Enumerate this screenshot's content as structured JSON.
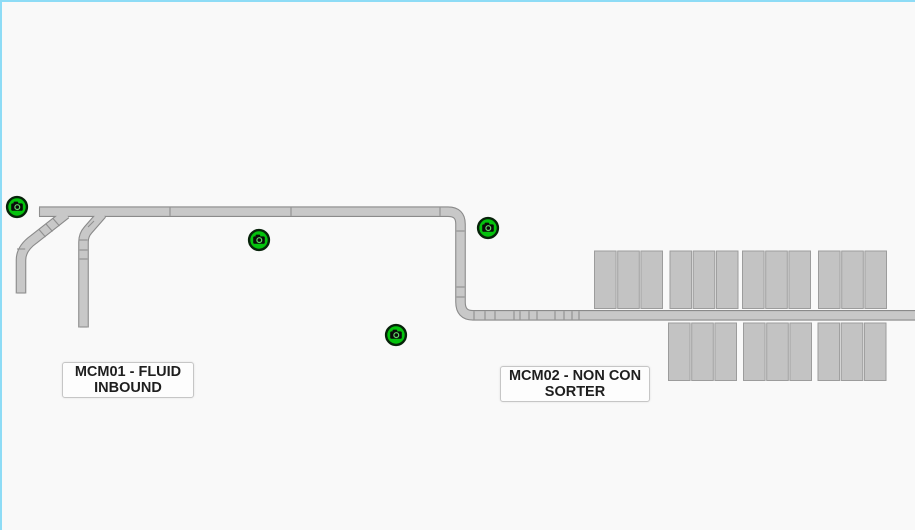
{
  "scene": {
    "background": "#f9f9f9",
    "frame_border_color": "#8edcf6"
  },
  "zone_labels": [
    {
      "id": "mcm01",
      "text": "MCM01 - FLUID\nINBOUND",
      "x": 60,
      "y": 360,
      "w": 132,
      "h": 36
    },
    {
      "id": "mcm02",
      "text": "MCM02 - NON CON\nSORTER",
      "x": 498,
      "y": 364,
      "w": 150,
      "h": 36
    }
  ],
  "cameras": {
    "style": {
      "halo": "#cbcbcb",
      "fill": "#04c30d",
      "ring": "#07230a",
      "glyph": "#0a0a0a",
      "lens_ring": "#63d96a"
    },
    "items": [
      {
        "id": "cam-1",
        "cx": 15,
        "cy": 205
      },
      {
        "id": "cam-2",
        "cx": 257,
        "cy": 238
      },
      {
        "id": "cam-3",
        "cx": 486,
        "cy": 226
      },
      {
        "id": "cam-4",
        "cx": 394,
        "cy": 333
      }
    ]
  },
  "conveyors": {
    "style": {
      "edge": "#8a8a8a",
      "fill": "#c8c8c8",
      "edge_width": 10.6,
      "fill_width": 8.4,
      "seam": "#8f8f8f"
    },
    "paths": [
      {
        "id": "mainline",
        "d": "M 37 209.7 H 446 Q 458.5 209.7 458.5 222 V 300 Q 458.5 313.3 471 313.3 H 916"
      },
      {
        "id": "spur-left",
        "d": "M 64 212 L 31.5 237.5 Q 19 246.5 19 258 V 291.5"
      },
      {
        "id": "spur-mid",
        "d": "M 100 212 L 86 228 Q 81.5 233 81.5 240 V 325.5"
      }
    ],
    "seams": [
      [
        37.5,
        205.6,
        37.5,
        213.9
      ],
      [
        168,
        205.6,
        168,
        213.9
      ],
      [
        289,
        205.6,
        289,
        213.9
      ],
      [
        438,
        205.6,
        438,
        213.9
      ],
      [
        454.4,
        229,
        462.6,
        229
      ],
      [
        454.4,
        285,
        462.6,
        285
      ],
      [
        454.4,
        295,
        462.6,
        295
      ],
      [
        472,
        309.2,
        472,
        317.4
      ],
      [
        483,
        309.2,
        483,
        317.4
      ],
      [
        493,
        309.2,
        493,
        317.4
      ],
      [
        512,
        309.2,
        512,
        317.4
      ],
      [
        518,
        309.2,
        518,
        317.4
      ],
      [
        527,
        309.2,
        527,
        317.4
      ],
      [
        535,
        309.2,
        535,
        317.4
      ],
      [
        553,
        309.2,
        553,
        317.4
      ],
      [
        562,
        309.2,
        562,
        317.4
      ],
      [
        570,
        309.2,
        570,
        317.4
      ],
      [
        577,
        309.2,
        577,
        317.4
      ],
      [
        51,
        216.5,
        57.5,
        224
      ],
      [
        44,
        222,
        50.5,
        229.5
      ],
      [
        37,
        227.5,
        43.5,
        235
      ],
      [
        15,
        247,
        23.2,
        247
      ],
      [
        15,
        291,
        23.2,
        291
      ],
      [
        86,
        225,
        92,
        219
      ],
      [
        77.5,
        238,
        85.6,
        238
      ],
      [
        77.5,
        248,
        85.6,
        248
      ],
      [
        77.5,
        257,
        85.6,
        257
      ],
      [
        77.5,
        325,
        85.6,
        325
      ]
    ]
  },
  "chutes": {
    "style": {
      "fill": "#c3c3c3",
      "edge": "#9c9c9c"
    },
    "block_width": 21.6,
    "block_height": 57.5,
    "block_gap": 1.6,
    "blocks_per_group": 3,
    "rows": [
      {
        "id": "above-line",
        "y": 249,
        "group_x": [
          592.5,
          668,
          740.5,
          816.5
        ]
      },
      {
        "id": "below-line",
        "y": 321,
        "group_x": [
          666.5,
          741.5,
          816
        ]
      }
    ]
  }
}
